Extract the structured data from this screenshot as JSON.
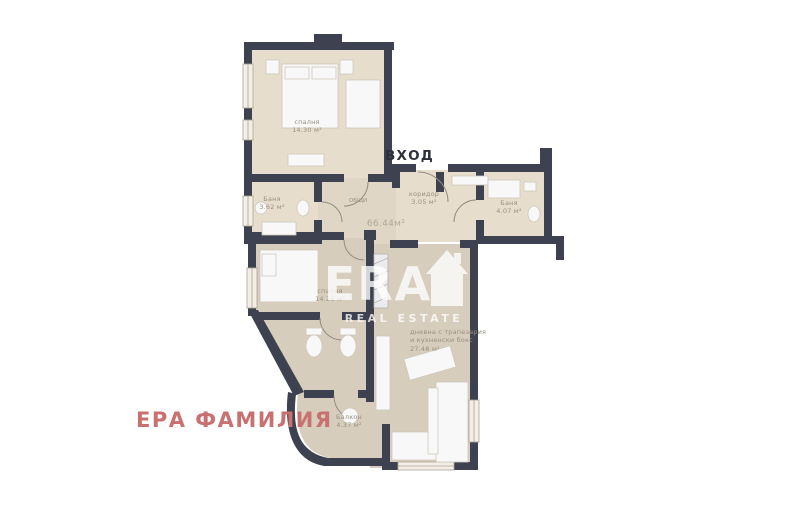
{
  "page": {
    "title": "apartment-floor-plan"
  },
  "plan": {
    "entrance_label": "ВХОД",
    "brand_label": "ЕРА ФАМИЛИЯ",
    "watermark": {
      "text": "ERA",
      "subtext": "REAL ESTATE"
    },
    "total": {
      "label": "ОБЩИ",
      "value": "66.44м²"
    },
    "rooms": [
      {
        "name": "спалня",
        "area": "14.30 м²"
      },
      {
        "name": "Баня",
        "area": "3.62 м²"
      },
      {
        "name": "коридор",
        "area": "3.05 м²"
      },
      {
        "name": "Баня",
        "area": "4.07 м²"
      },
      {
        "name": "спалня",
        "area": "14.26 м²"
      },
      {
        "name": "дневна с трапезария",
        "name_line2": "и кухненски бокс",
        "area": "27.48 м²"
      },
      {
        "name": "Балкон",
        "area": "4.37 м²"
      }
    ],
    "colors": {
      "wall": "#3e4250",
      "floor-upper": "#e6ddcc",
      "floor-hall": "#e0d6c5",
      "floor-lower": "#d7cdbc",
      "furniture": "#f8f8f9",
      "furniture-stroke": "#cfc8bb",
      "label": "#9a9183",
      "entrance-text": "#2d313b",
      "brand-text": "#c87170",
      "watermark": "rgba(255,255,255,0.78)"
    }
  }
}
